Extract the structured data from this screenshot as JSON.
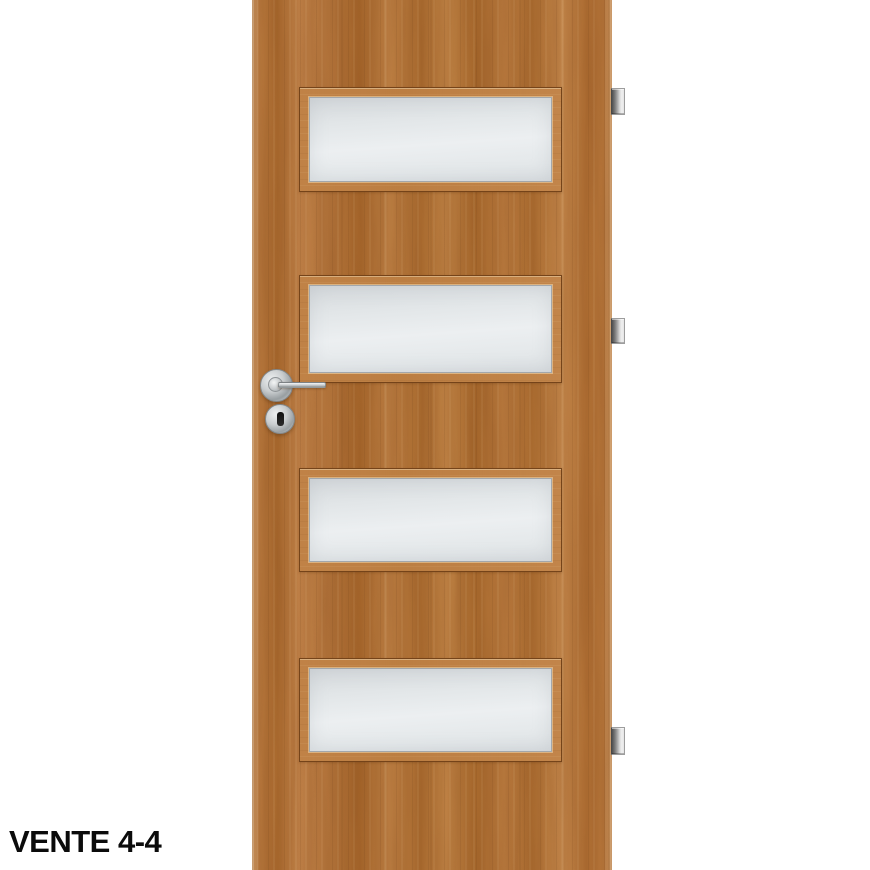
{
  "product": {
    "label": "VENTE 4-4"
  },
  "door": {
    "panel_count": 4,
    "hinge_count": 3,
    "handle_side": "left",
    "hinge_side": "right",
    "colors": {
      "wood_base": "#b4753a",
      "wood_dark": "#a8682c",
      "wood_light": "#c4874b",
      "frame_outline": "#6d3d15",
      "glass": "#eceff1",
      "glass_edge": "#a3a7ab",
      "chrome": "#c6cacc",
      "hinge_dark": "#4f4f4f",
      "hinge_light": "#f0f0f0",
      "keyhole": "#101010",
      "background": "#ffffff",
      "label_text": "#0b0b0b"
    },
    "icons": {
      "door-handle-lever-icon": "css-shape",
      "keyhole-icon": "css-shape",
      "hinge-icon": "css-shape"
    }
  }
}
